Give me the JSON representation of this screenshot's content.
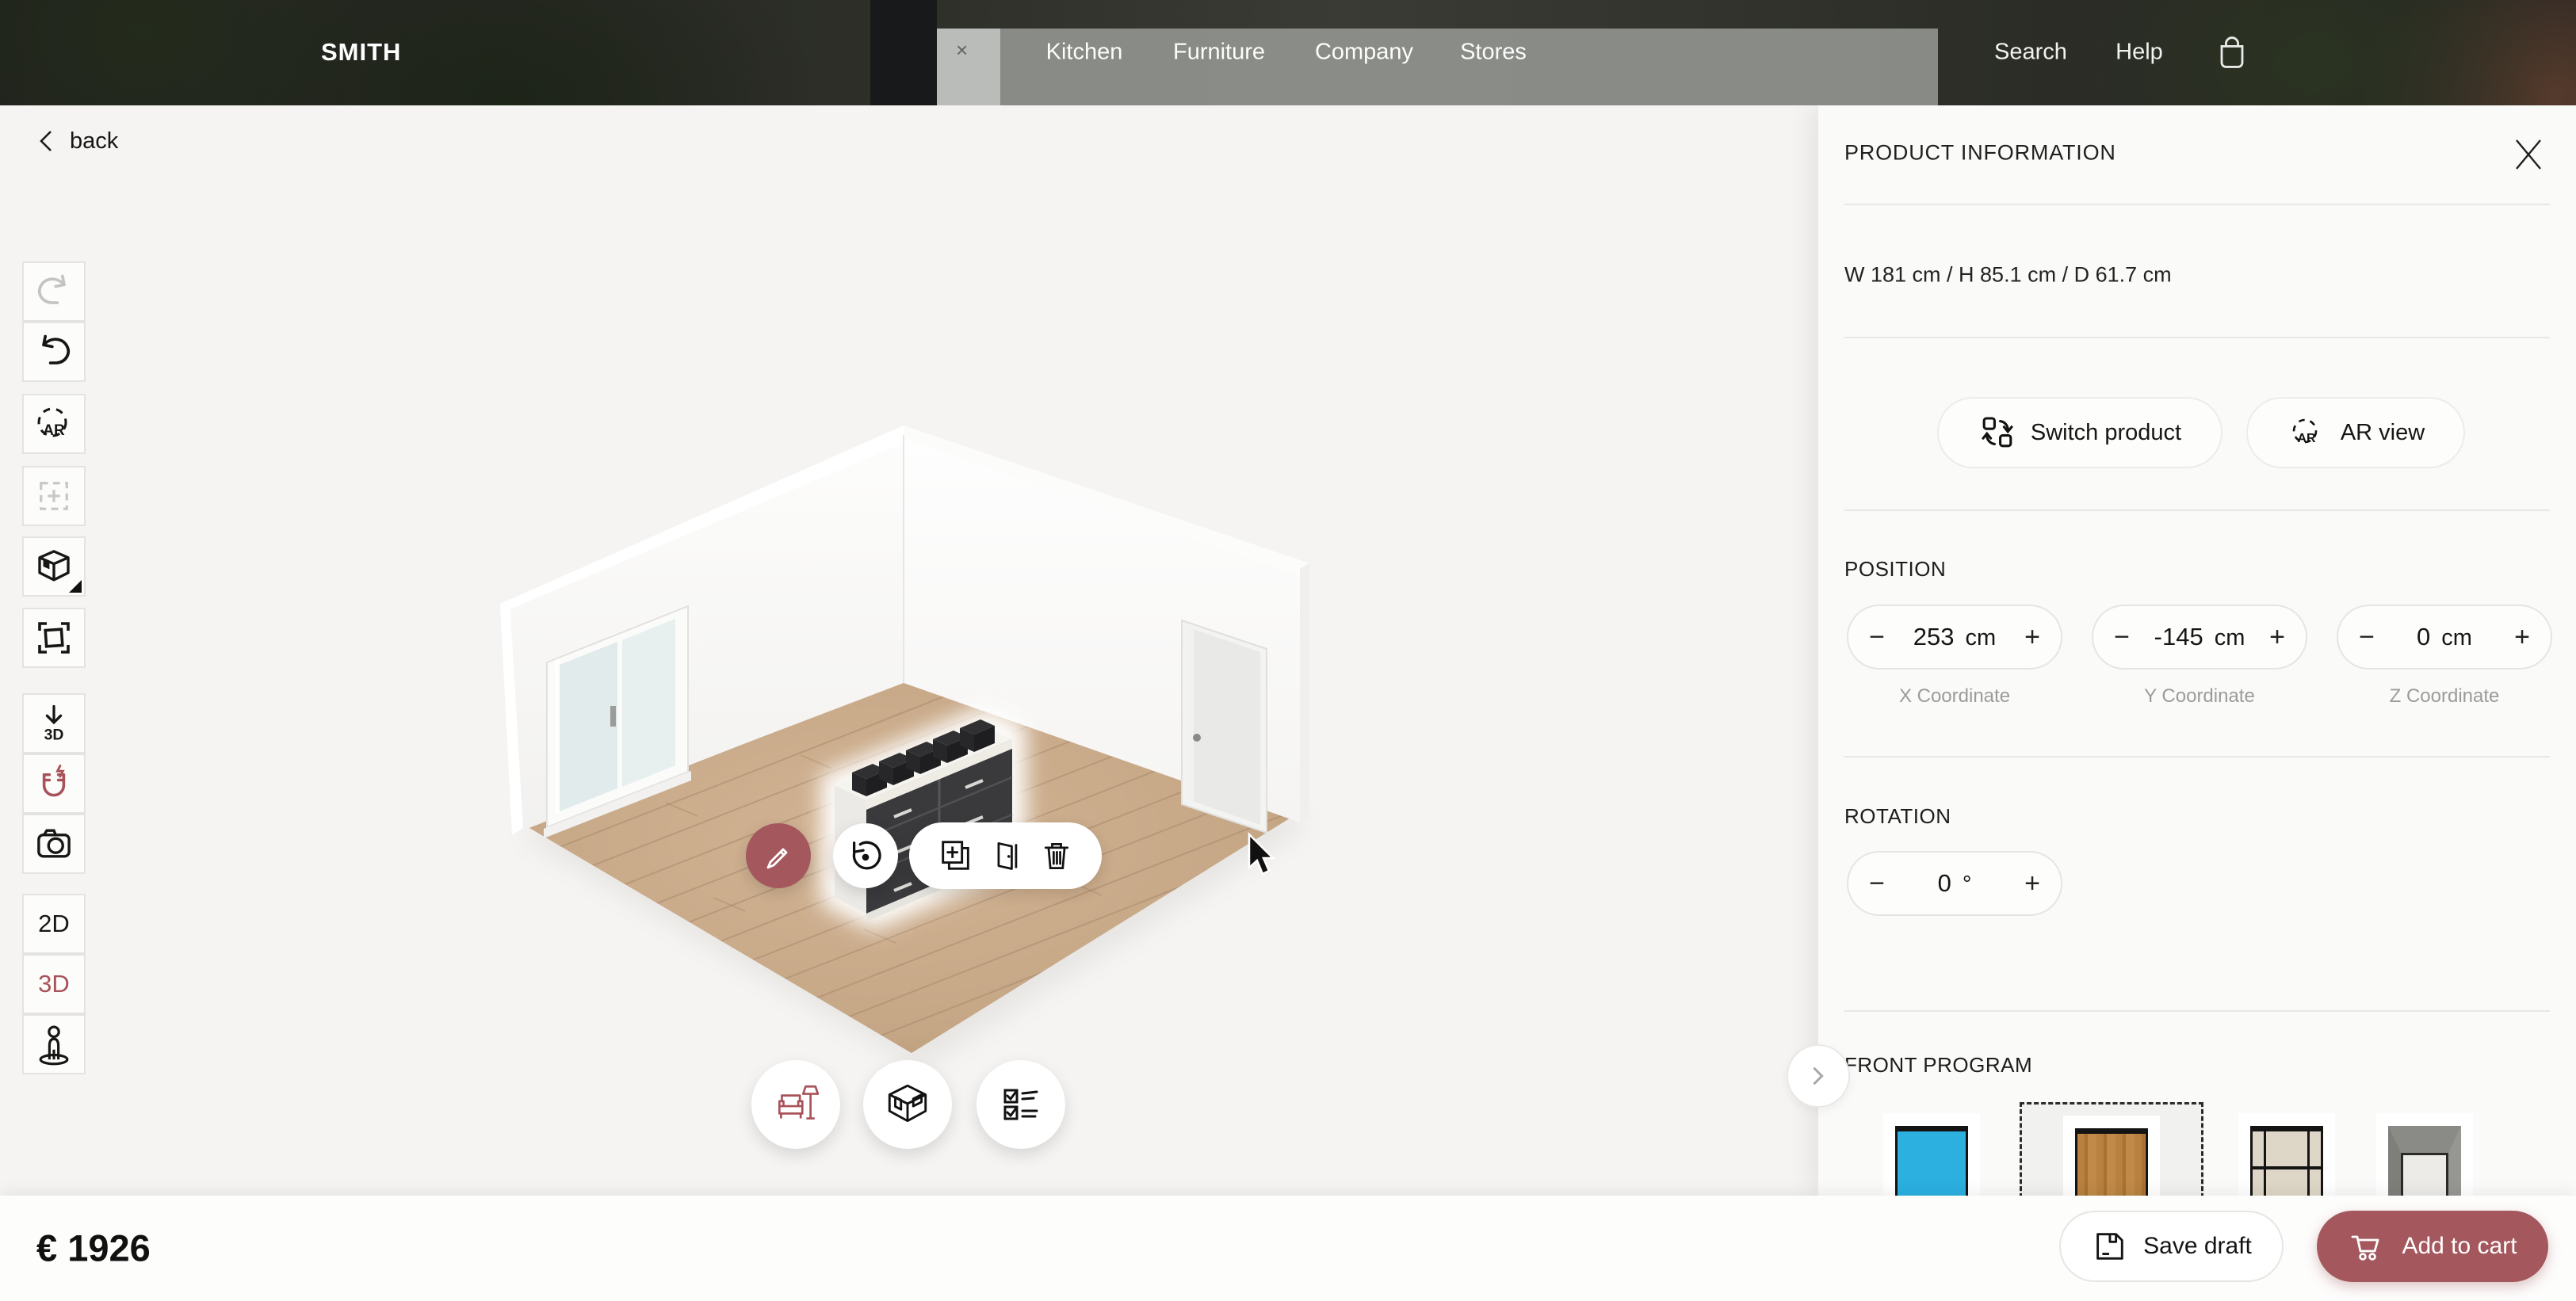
{
  "topbar": {
    "brand": "SMITH",
    "nav": [
      {
        "label": "Kitchen"
      },
      {
        "label": "Furniture"
      },
      {
        "label": "Company"
      },
      {
        "label": "Stores"
      }
    ],
    "search_label": "Search",
    "help_label": "Help"
  },
  "canvas": {
    "back_label": "back",
    "sidebar": {
      "ar_label": "AR",
      "download3d_label": "3D",
      "view2d_label": "2D",
      "view3d_label": "3D"
    }
  },
  "panel": {
    "title": "PRODUCT INFORMATION",
    "dimensions": "W 181 cm / H 85.1 cm / D 61.7 cm",
    "switch_product_label": "Switch product",
    "ar_view_label": "AR view",
    "ar_icon_label": "AR",
    "position": {
      "label": "POSITION",
      "steppers": [
        {
          "value": "253",
          "unit": "cm",
          "label": "X Coordinate"
        },
        {
          "value": "-145",
          "unit": "cm",
          "label": "Y Coordinate"
        },
        {
          "value": "0",
          "unit": "cm",
          "label": "Z Coordinate"
        }
      ]
    },
    "rotation": {
      "label": "ROTATION",
      "stepper": {
        "value": "0",
        "unit": "°"
      }
    },
    "front_program": {
      "label": "FRONT PROGRAM"
    }
  },
  "bottom_bar": {
    "price": "€ 1926",
    "save_draft_label": "Save draft",
    "add_to_cart_label": "Add to cart"
  },
  "icons": {
    "minus": "−",
    "plus": "+",
    "photo_close": "×"
  },
  "colors": {
    "accent": "#a4585d",
    "swatch_blue": "#2bb0e0",
    "active_tool": "#a8535a"
  }
}
